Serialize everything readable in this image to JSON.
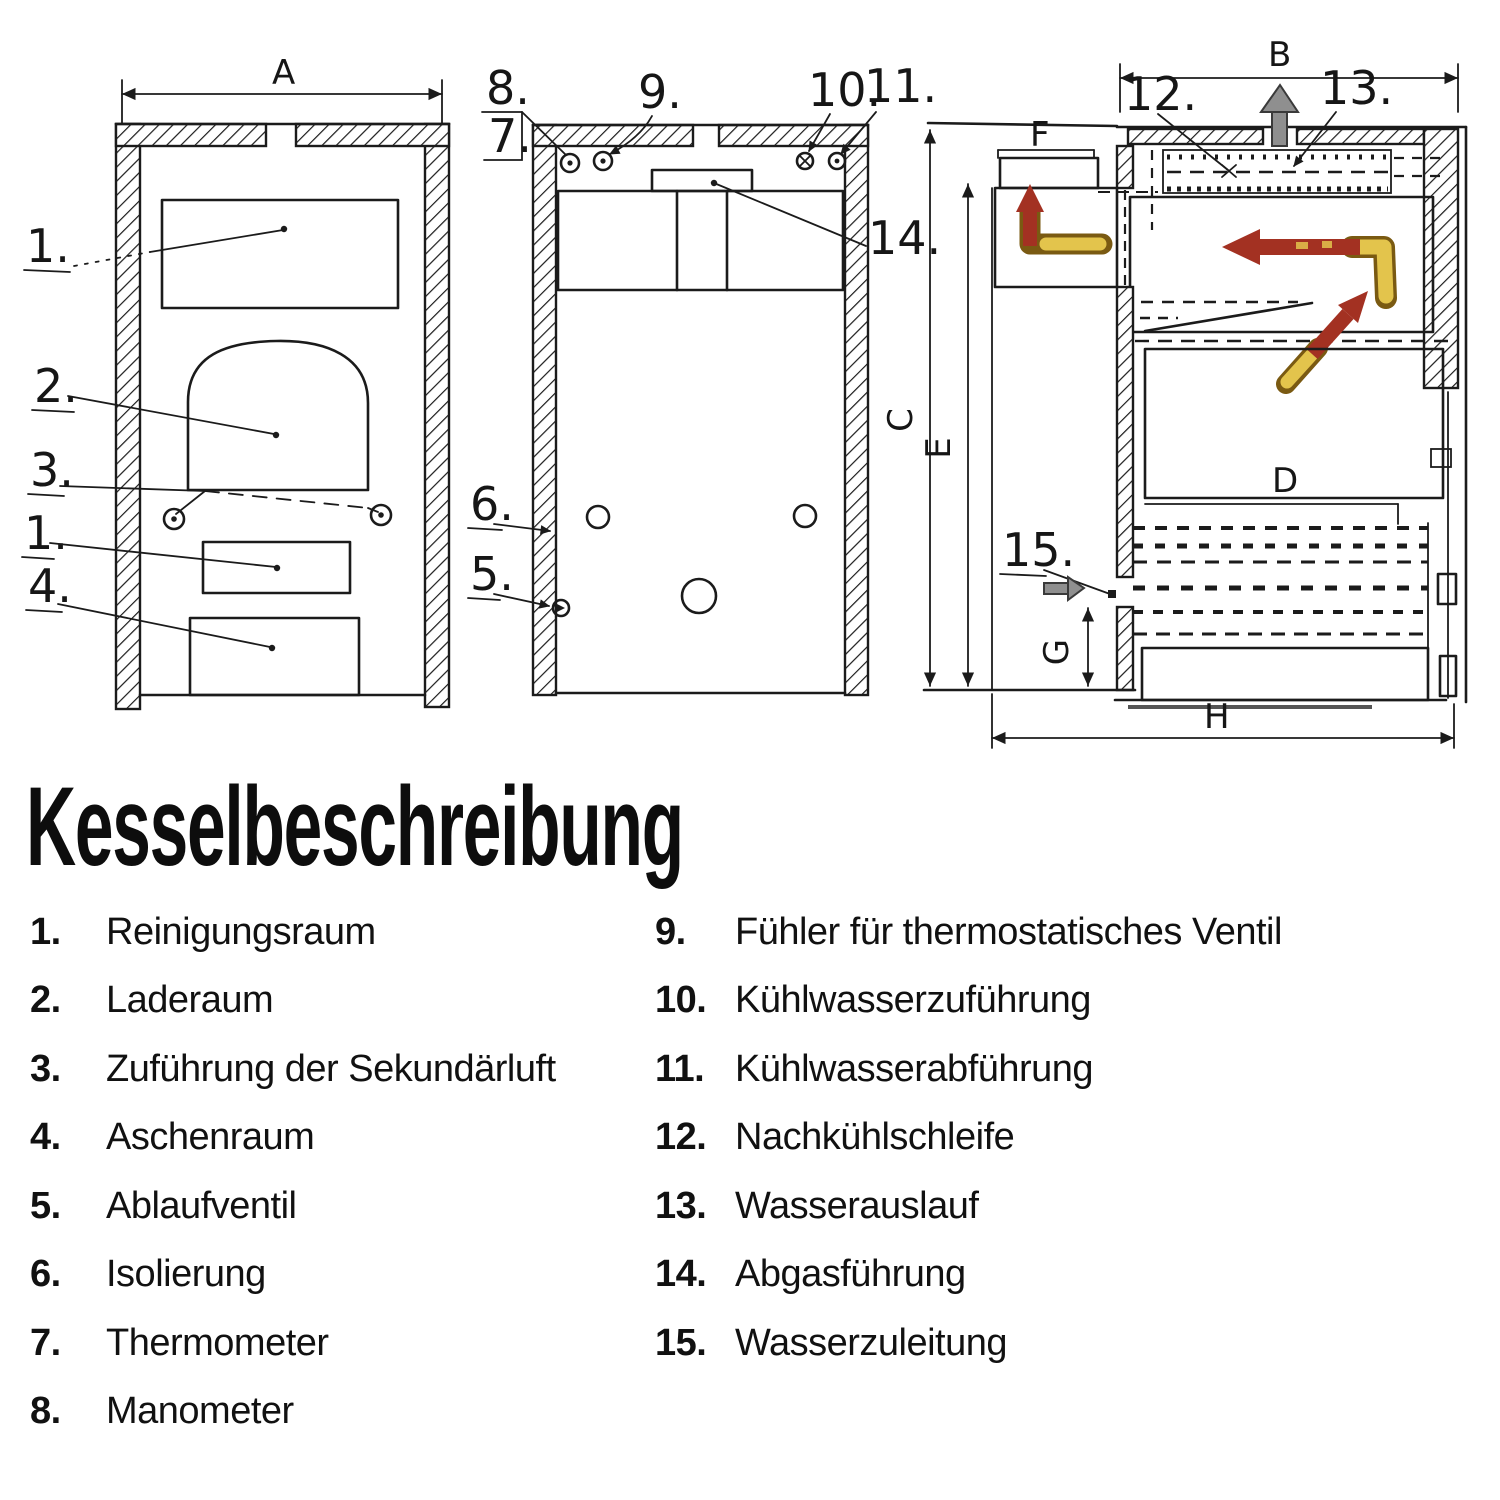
{
  "title": {
    "heading": "Kesselbeschreibung"
  },
  "legend": {
    "left": [
      {
        "num": "1.",
        "label": "Reinigungsraum"
      },
      {
        "num": "2.",
        "label": "Laderaum"
      },
      {
        "num": "3.",
        "label": "Zuführung der Sekundärluft"
      },
      {
        "num": "4.",
        "label": "Aschenraum"
      },
      {
        "num": "5.",
        "label": "Ablaufventil"
      },
      {
        "num": "6.",
        "label": "Isolierung"
      },
      {
        "num": "7.",
        "label": "Thermometer"
      },
      {
        "num": "8.",
        "label": "Manometer"
      }
    ],
    "right": [
      {
        "num": "9.",
        "label": "Fühler für thermostatisches Ventil"
      },
      {
        "num": "10.",
        "label": "Kühlwasserzuführung"
      },
      {
        "num": "11.",
        "label": "Kühlwasserabführung"
      },
      {
        "num": "12.",
        "label": "Nachkühlschleife"
      },
      {
        "num": "13.",
        "label": "Wasserauslauf"
      },
      {
        "num": "14.",
        "label": "Abgasführung"
      },
      {
        "num": "15.",
        "label": "Wasserzuleitung"
      }
    ]
  },
  "diagram": {
    "colors": {
      "ink": "#1b1b1b",
      "flow_red": "#a33122",
      "flow_yellow": "#e3c44c",
      "arrow_gray": "#8f8f8f"
    },
    "front": {
      "dim_a": "A",
      "c1": "1.",
      "c2": "2.",
      "c3": "3.",
      "c1b": "1.",
      "c4": "4."
    },
    "rear": {
      "c8": "8.",
      "c7": "7.",
      "c9": "9.",
      "c10": "10.",
      "c11": "11.",
      "c14": "14.",
      "c6": "6.",
      "c5": "5."
    },
    "side": {
      "dim_b": "B",
      "dim_c": "C",
      "dim_d": "D",
      "dim_e": "E",
      "dim_f": "F",
      "dim_g": "G",
      "dim_h": "H",
      "c12": "12.",
      "c13": "13.",
      "c15": "15."
    }
  }
}
